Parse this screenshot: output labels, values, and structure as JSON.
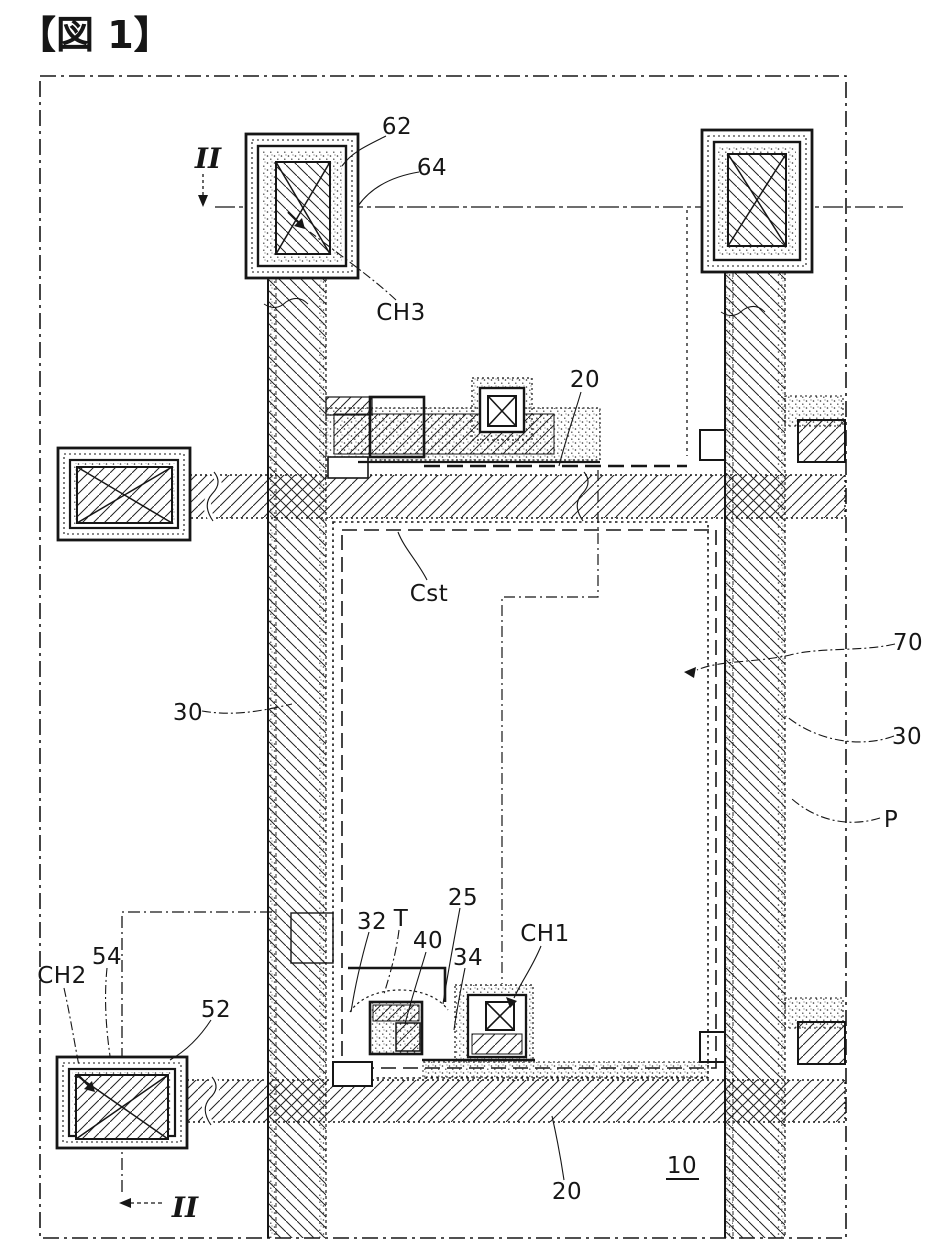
{
  "figure": {
    "title": "【図 1】",
    "type": "patent-plan-view-drawing",
    "description": "Plan view of a thin-film-transistor array substrate pixel (patent Figure 1)"
  },
  "section_markers": {
    "top": "II",
    "bottom": "II"
  },
  "labels": {
    "title": "【図 1】",
    "iit": "II",
    "iib": "II",
    "l62": "62",
    "l64": "64",
    "lch3": "CH3",
    "l20t": "20",
    "lcst": "Cst",
    "l70": "70",
    "l30r": "30",
    "lp": "P",
    "l30l": "30",
    "l25": "25",
    "l32": "32",
    "lt": "T",
    "l40": "40",
    "l34": "34",
    "lch1": "CH1",
    "lch2": "CH2",
    "l54": "54",
    "l52": "52",
    "l10": "10",
    "l20b": "20"
  },
  "colors": {
    "ink": "#161616",
    "paper": "#ffffff"
  }
}
